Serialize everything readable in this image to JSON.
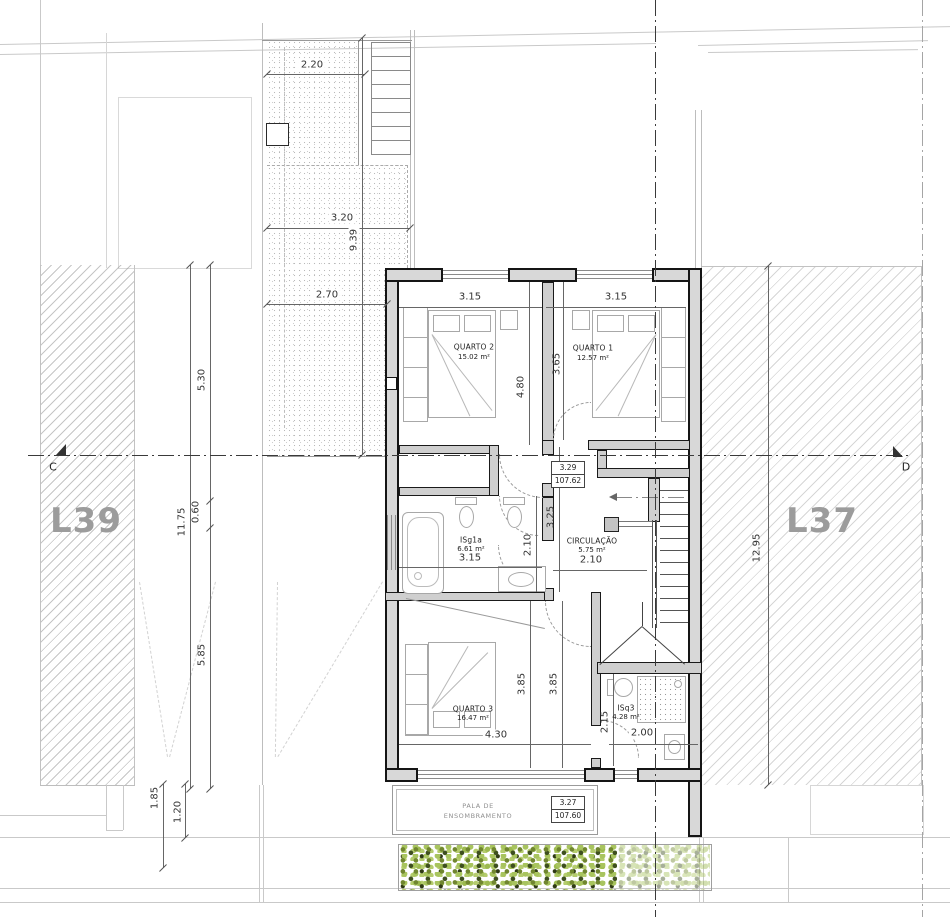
{
  "site": {
    "lot_left_label": "L39",
    "lot_right_label": "L37",
    "section_marker_left": "C",
    "section_marker_right": "D",
    "right_lot_dimension": "12.95"
  },
  "courtyard_dimensions": {
    "top_width": "2.20",
    "mid_width": "3.20",
    "depth": "9.39",
    "lower_width": "2.70"
  },
  "left_dimensions": {
    "total": "11.75",
    "seg_a": "5.30",
    "seg_b": "0.60",
    "seg_c": "5.85",
    "front_a": "1.85",
    "front_b": "1.20"
  },
  "rooms": {
    "quarto2": {
      "name": "QUARTO 2",
      "area": "15.02 m²",
      "width": "3.15",
      "depth": "4.80"
    },
    "quarto1": {
      "name": "QUARTO 1",
      "area": "12.57 m²",
      "width": "3.15",
      "depth": "3.65"
    },
    "isg1a": {
      "name": "ISg1a",
      "area": "6.61 m²",
      "width": "3.15",
      "depth": "2.10"
    },
    "circulacao": {
      "name": "CIRCULAÇÃO",
      "area": "5.75 m²",
      "width": "2.10",
      "length": "3.25"
    },
    "quarto3": {
      "name": "QUARTO 3",
      "area": "16.47 m²",
      "width": "4.30",
      "depth_a": "3.85",
      "depth_b": "3.85"
    },
    "isq3": {
      "name": "ISq3",
      "area": "4.28 m²",
      "width": "2.00",
      "depth": "2.15"
    }
  },
  "levels": {
    "floor": {
      "level": "3.29",
      "elevation": "107.62"
    },
    "canopy": {
      "level": "3.27",
      "elevation": "107.60"
    }
  },
  "canopy": {
    "line1": "PALA DE",
    "line2": "ENSOMBRAMENTO"
  },
  "colors": {
    "wall_fill": "#d8d8d8",
    "hatch_line": "#c2c2c2",
    "hedge_light": "#a8c45e",
    "hedge_dark": "#3e4f1f",
    "dimension_text": "#333333"
  }
}
